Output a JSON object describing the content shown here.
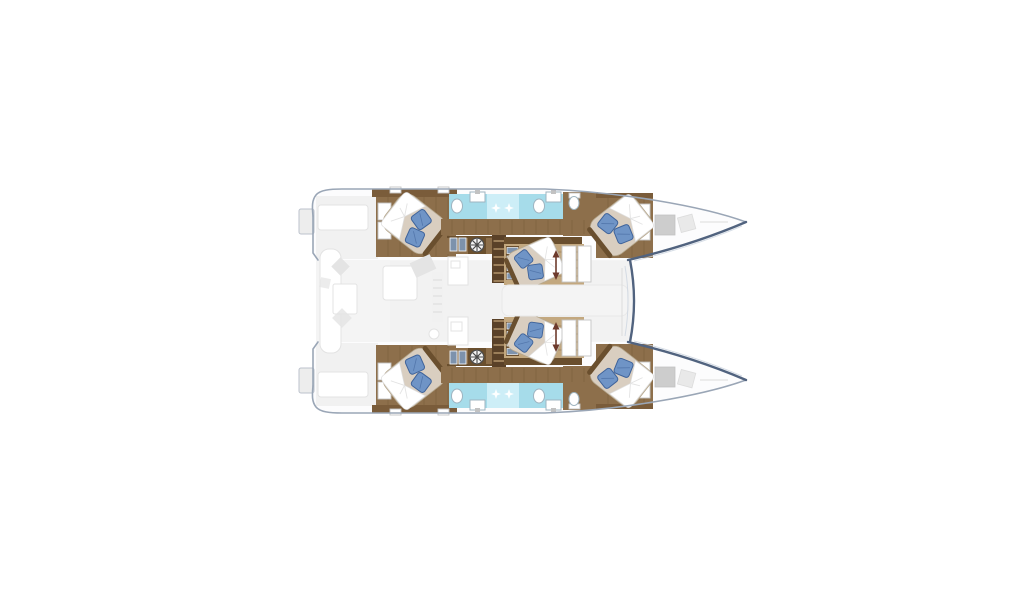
{
  "page": {
    "background": "#ffffff"
  },
  "plan": {
    "subject": "catamaran-yacht-deck-plan-top-view-bows-right",
    "hulls": 2,
    "double_beds": 6,
    "pillows_per_bed": 2,
    "bathroom_strips": 2,
    "shower_sparkles": 4,
    "washer_icons": 2,
    "staircases": 4,
    "colors": {
      "hull_fill": "#fcfcfd",
      "hull_edge": "#9aa6b6",
      "bow_edge": "#51637f",
      "deck_ghost": "#f1f1f1",
      "salon_ghost": "#f4f4f4",
      "ghost_shape": "#e4e4e4",
      "wood": "#8d6f4b",
      "wood_dark": "#6a4f2e",
      "wood_light": "#c3a87f",
      "trim": "#7a5c3a",
      "mattress": "#d9cec0",
      "mattress_edge": "#b5a78d",
      "sheet": "#ffffff",
      "pillow": "#6f94c6",
      "pillow_dark": "#3f639a",
      "bathroom": "#a6dcea",
      "shower": "#cdeef7",
      "fixture_stroke": "#9fb4c0",
      "unit_blue": "#7d92ac",
      "step_blue": "#7e93ad",
      "hatch_gray": "#cdcdcd",
      "arrow": "#6d3a2c",
      "washer_ring": "#4b4b4b"
    }
  }
}
